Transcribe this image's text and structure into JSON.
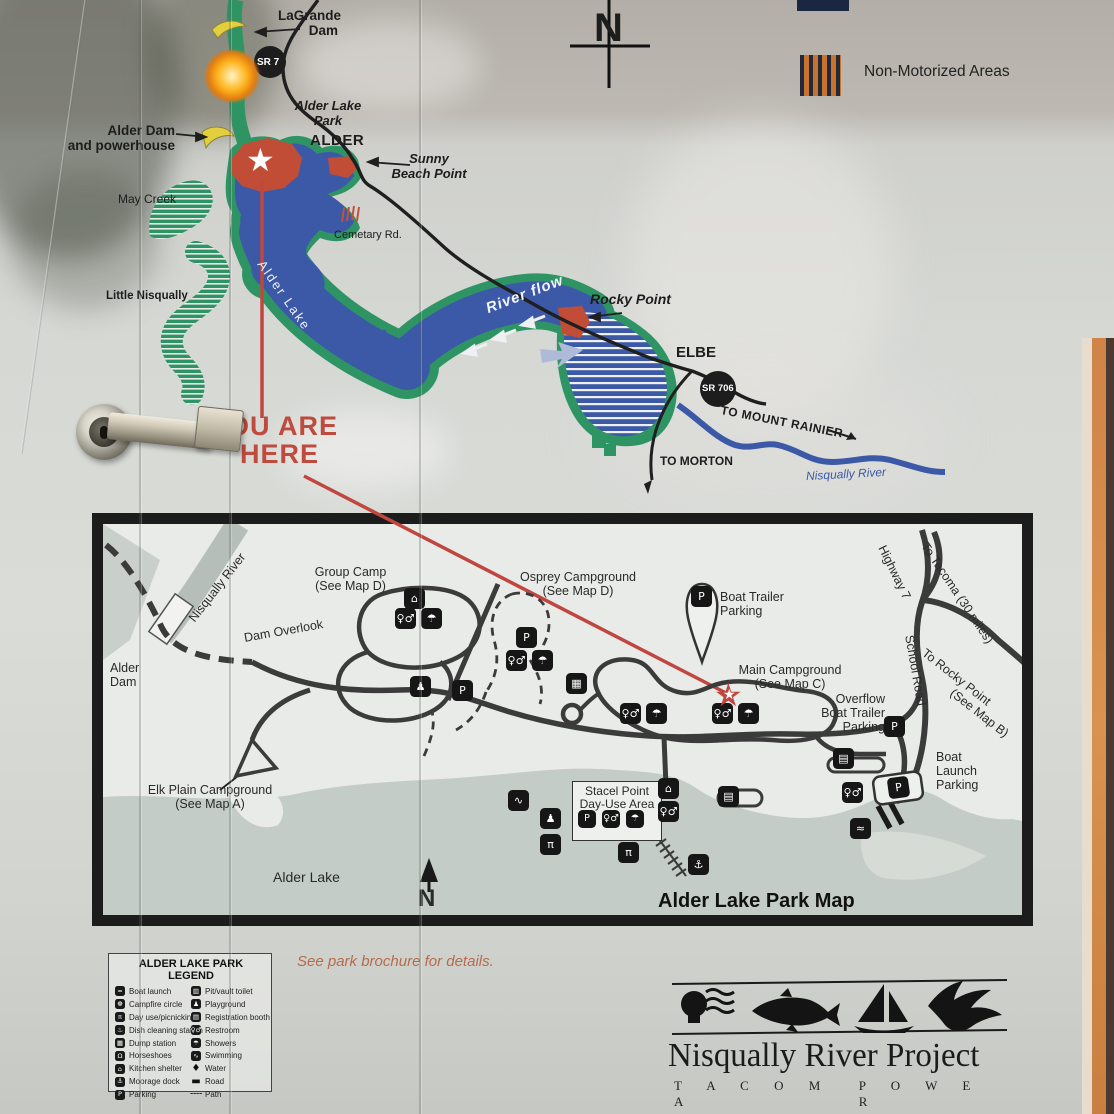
{
  "colors": {
    "lake_blue": "#3c59a8",
    "shore_green": "#2f9464",
    "marker_red": "#c24d36",
    "dam_yellow": "#e3cf3e",
    "here_red": "#bf4a3e",
    "park_lake_gray": "#c3ccc6",
    "note_orange": "#b86a4a",
    "nonmotor_orange": "#c8742f",
    "nonmotor_navy": "#23293a"
  },
  "icons": {
    "parking": "P",
    "restroom": "♀♂",
    "showers": "☂",
    "picnic": "π",
    "kitchen-shelter": "⌂",
    "playground": "♟",
    "swimming": "∿",
    "dump-station": "▦",
    "registration-booth": "▤",
    "moorage-anchor": "⚓",
    "boat-launch": "≈",
    "pit-toilet": "▥",
    "campfire": "☸",
    "dish-cleaning": "♨",
    "horseshoes": "Ω",
    "water": "♦",
    "road": "▬",
    "path": "╌╌",
    "star": "★"
  },
  "upper_map": {
    "compass_n": "N",
    "non_motorized_label": "Non-Motorized Areas",
    "you_are_here_line1": "OU ARE",
    "you_are_here_line2": "HERE",
    "labels": {
      "lagrande_1": "LaGrande",
      "lagrande_2": "Dam",
      "sr7": "SR 7",
      "alder_lake_park_1": "Alder Lake",
      "alder_lake_park_2": "Park",
      "alder": "ALDER",
      "alder_dam_1": "Alder Dam",
      "alder_dam_2": "and powerhouse",
      "may_creek": "May Creek",
      "little_nisqually": "Little Nisqually",
      "cemetary_rd": "Cemetary Rd.",
      "sunny_1": "Sunny",
      "sunny_2": "Beach Point",
      "alder_lake_rot": "Alder Lake",
      "river_flow": "River flow",
      "rocky_point": "Rocky Point",
      "elbe": "ELBE",
      "sr706": "SR 706",
      "to_mount_rainier": "TO MOUNT RAINIER",
      "to_morton": "TO MORTON",
      "nisqually_river": "Nisqually River"
    }
  },
  "park_map": {
    "title": "Alder Lake Park Map",
    "compass_n": "N",
    "labels": {
      "nisqually_river": "Nisqually River",
      "group_camp_1": "Group Camp",
      "group_camp_2": "(See Map D)",
      "dam_overlook": "Dam Overlook",
      "alder_dam_1": "Alder",
      "alder_dam_2": "Dam",
      "osprey_1": "Osprey Campground",
      "osprey_2": "(See Map D)",
      "boat_trailer_1": "Boat Trailer",
      "boat_trailer_2": "Parking",
      "main_campground_1": "Main Campground",
      "main_campground_2": "(See Map C)",
      "overflow_1": "Overflow",
      "overflow_2": "Boat Trailer",
      "overflow_3": "Parking",
      "highway7": "Highway 7",
      "to_tacoma": "To Tacoma (30 miles)",
      "school_road": "School Road",
      "to_rocky_1": "To Rocky Point",
      "to_rocky_2": "(See Map B)",
      "boat_launch_1": "Boat",
      "boat_launch_2": "Launch",
      "boat_launch_3": "Parking",
      "elk_plain_1": "Elk Plain Campground",
      "elk_plain_2": "(See Map A)",
      "stacel_1": "Stacel Point",
      "stacel_2": "Day-Use Area",
      "alder_lake": "Alder Lake"
    }
  },
  "legend": {
    "title": "ALDER LAKE PARK LEGEND",
    "left": [
      {
        "icon": "boat-launch",
        "label": "Boat launch"
      },
      {
        "icon": "campfire",
        "label": "Campfire circle"
      },
      {
        "icon": "picnic",
        "label": "Day use/picnicking"
      },
      {
        "icon": "dish-cleaning",
        "label": "Dish cleaning station"
      },
      {
        "icon": "dump-station",
        "label": "Dump station"
      },
      {
        "icon": "horseshoes",
        "label": "Horseshoes"
      },
      {
        "icon": "kitchen-shelter",
        "label": "Kitchen shelter"
      },
      {
        "icon": "moorage-anchor",
        "label": "Moorage dock"
      },
      {
        "icon": "parking",
        "label": "Parking"
      }
    ],
    "right": [
      {
        "icon": "pit-toilet",
        "label": "Pit/vault toilet"
      },
      {
        "icon": "playground",
        "label": "Playground"
      },
      {
        "icon": "registration-booth",
        "label": "Registration booth"
      },
      {
        "icon": "restroom",
        "label": "Restroom"
      },
      {
        "icon": "showers",
        "label": "Showers"
      },
      {
        "icon": "swimming",
        "label": "Swimming"
      },
      {
        "icon": "water",
        "label": "Water"
      },
      {
        "icon": "road",
        "label": "Road"
      },
      {
        "icon": "path",
        "label": "Path"
      }
    ]
  },
  "footer": {
    "note": "See park brochure for details.",
    "project": "Nisqually River Project",
    "company_word1": "T A C O M A",
    "company_word2": "P O W E R"
  }
}
